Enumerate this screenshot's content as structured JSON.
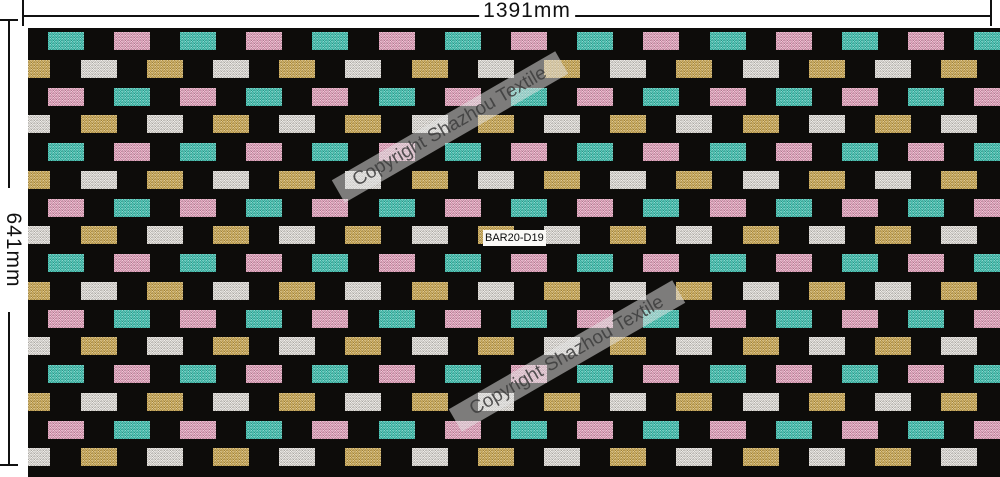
{
  "dimensions": {
    "width_label": "1391mm",
    "height_label": "641mm"
  },
  "watermark": {
    "text": "Copyright Shazhou Textile"
  },
  "swatch_label": "BAR20-D19",
  "pattern": {
    "background": "#0d0c0a",
    "colors": {
      "teal": "#3fc8b7",
      "pink": "#eea9c5",
      "gold": "#d4af55",
      "white": "#eae7e1"
    },
    "row_types": [
      {
        "pair": [
          "teal",
          "pink"
        ],
        "offset": "a"
      },
      {
        "pair": [
          "gold",
          "white"
        ],
        "offset": "b"
      },
      {
        "pair": [
          "pink",
          "teal"
        ],
        "offset": "a"
      },
      {
        "pair": [
          "white",
          "gold"
        ],
        "offset": "b"
      }
    ],
    "grid": {
      "rows": 16,
      "cols": 15,
      "pitch_x": 66.2,
      "pitch_y": 27.75,
      "tile_w": 36,
      "tile_h": 18,
      "first_row_y": 4,
      "offset_a": 19.5,
      "offset_b": -13.7
    }
  }
}
